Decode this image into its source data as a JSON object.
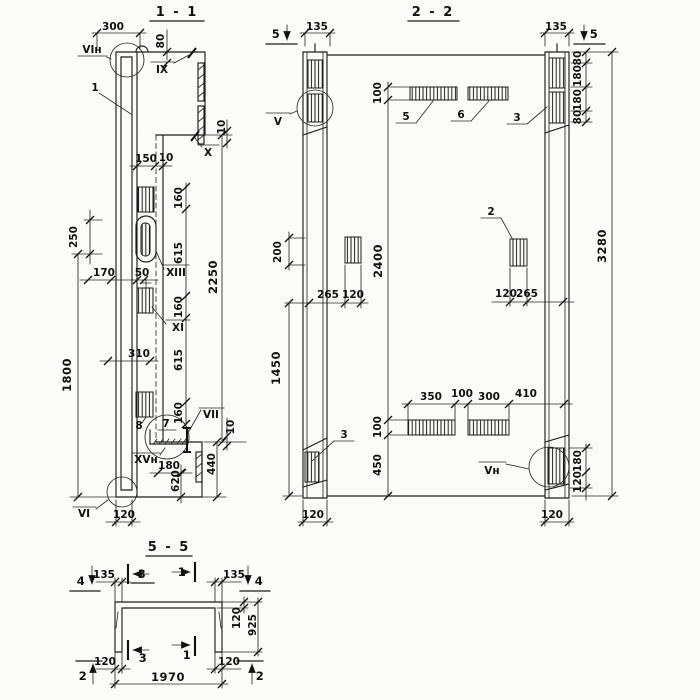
{
  "drawing": {
    "background": "#fbfbf9",
    "ink_color": "#1d1d1d"
  },
  "sections": {
    "s11": {
      "title": "1 - 1",
      "dims": {
        "d300": "300",
        "d80": "80",
        "d10top": "10",
        "d150": "150",
        "d10mid": "10",
        "d160a": "160",
        "d615a": "615",
        "d160b": "160",
        "d615b": "615",
        "d160c": "160",
        "d2250": "2250",
        "d250": "250",
        "d170": "170",
        "d50": "50",
        "d310": "310",
        "d1800": "1800",
        "d180": "180",
        "d620": "620",
        "d440": "440",
        "d10bot": "10",
        "d120": "120"
      },
      "labels": {
        "vin": "VIн",
        "n1": "1",
        "ix": "IX",
        "x": "X",
        "xiii": "XIII",
        "xi": "XI",
        "n7": "7",
        "n8": "8",
        "vii": "VII",
        "xvn": "XVн",
        "vi": "VI"
      }
    },
    "s22": {
      "title": "2 - 2",
      "dims": {
        "d135l": "135",
        "d135r": "135",
        "d80a": "80",
        "d180a": "180",
        "d180b": "180",
        "d80b": "80",
        "d3280": "3280",
        "d2400": "2400",
        "d100top": "100",
        "d200": "200",
        "d265l": "265",
        "d120l": "120",
        "d120r": "120",
        "d265r": "265",
        "d1450": "1450",
        "d100bot": "100",
        "d450": "450",
        "d350": "350",
        "d100mid": "100",
        "d300": "300",
        "d410": "410",
        "d180br": "180",
        "d120br": "120",
        "d120bl": "120",
        "d120brc": "120"
      },
      "labels": {
        "m5l": "5",
        "m5r": "5",
        "v": "V",
        "n5": "5",
        "n6": "6",
        "n3t": "3",
        "n2": "2",
        "n3b": "3",
        "vn": "Vн"
      }
    },
    "s55": {
      "title": "5 - 5",
      "dims": {
        "d135l": "135",
        "d135r": "135",
        "d120top": "120",
        "d925": "925",
        "d120bl": "120",
        "d120br": "120",
        "d1970": "1970"
      },
      "labels": {
        "m4l": "4",
        "m4r": "4",
        "m3t": "3",
        "m1t": "1",
        "m3b": "3",
        "m1b": "1",
        "m2l": "2",
        "m2r": "2"
      }
    }
  }
}
